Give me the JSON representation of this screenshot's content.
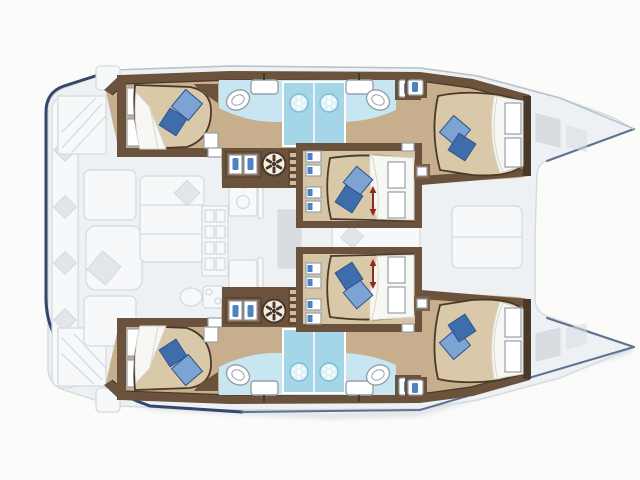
{
  "meta": {
    "title": "Catamaran yacht interior layout plan (top view, bows to the right)",
    "diagram_type": "boat-floor-plan"
  },
  "colors": {
    "bg": "#fbfbfa",
    "deck": "#eef1f4",
    "deck_line": "#d3d9dd",
    "furniture": "#f6f8f9",
    "cushion": "#e2e6ea",
    "hatch": "#d9dde1",
    "shadow": "#ccd3da",
    "navy": "#36456b",
    "blue_gray": "#5d7190",
    "light_line": "#b8c2cb",
    "wall": "#6a523c",
    "wall_dark": "#4a3828",
    "wall_light": "#7d5f44",
    "stair": "#5f4936",
    "step": "#cdbb9d",
    "floor": "#c7ae8d",
    "floor_light": "#d6c5a4",
    "bed": "#dac9a9",
    "duvet": "#f7f7f3",
    "duvet_line": "#d9d6cd",
    "pillow": "#7da3d3",
    "pillow_dark": "#3f6cab",
    "pillow_line": "#2c548f",
    "bath": "#c7e6f1",
    "shower": "#a4d6e8",
    "shower_ring": "#7fbdd4",
    "fixture_line": "#96a1aa",
    "jug": "#4d82c4",
    "red": "#8e2b1c"
  },
  "layout": {
    "hull_count": 2,
    "bow_direction": "right",
    "cabins": [
      {
        "id": "port-aft-cabin",
        "bed": "double",
        "pillows": 2
      },
      {
        "id": "port-forward-cabin",
        "bed": "double",
        "pillows": 2
      },
      {
        "id": "center-port-cabin",
        "bed": "double",
        "pillows": 2,
        "dimension_arrow": true
      },
      {
        "id": "center-starboard-cabin",
        "bed": "double",
        "pillows": 2,
        "dimension_arrow": true
      },
      {
        "id": "starboard-aft-cabin",
        "bed": "double",
        "pillows": 2
      },
      {
        "id": "starboard-forward-cabin",
        "bed": "double",
        "pillows": 2
      }
    ],
    "bathrooms": [
      {
        "id": "port-aft-head",
        "fixtures": [
          "toilet",
          "sink",
          "shower"
        ]
      },
      {
        "id": "port-forward-head",
        "fixtures": [
          "toilet",
          "sink",
          "shower"
        ]
      },
      {
        "id": "starboard-aft-head",
        "fixtures": [
          "toilet",
          "sink",
          "shower"
        ]
      },
      {
        "id": "starboard-forward-head",
        "fixtures": [
          "toilet",
          "sink",
          "shower"
        ]
      }
    ],
    "deck_features": [
      "aft-cockpit-bench",
      "cockpit-table",
      "saloon-settee",
      "galley",
      "companionway-stairs",
      "bow-deck-hatches"
    ]
  }
}
